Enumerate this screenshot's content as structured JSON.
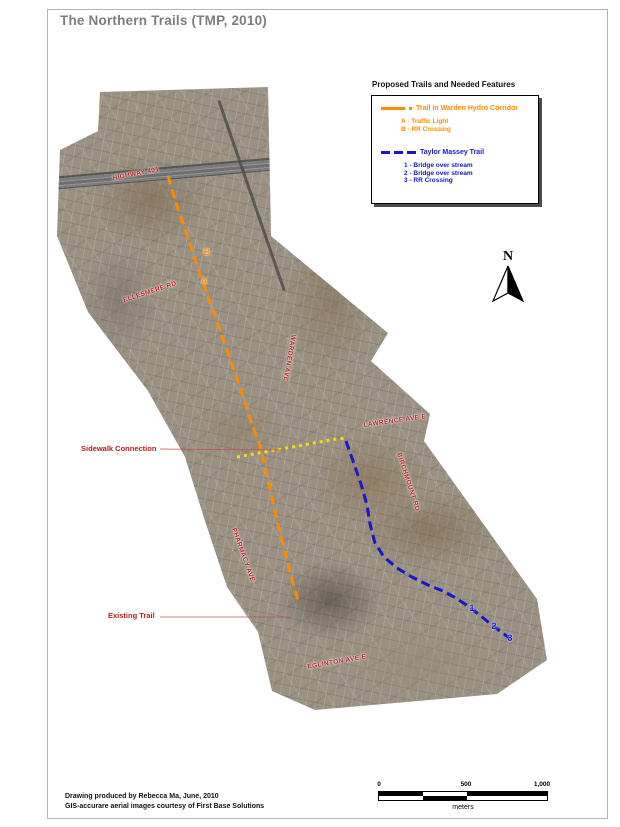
{
  "page": {
    "title": "The Northern Trails (TMP, 2010)",
    "credits": [
      "Drawing produced by Rebecca Ma, June, 2010",
      "GIS-accurare aerial images courtesy of First Base Solutions"
    ]
  },
  "legend": {
    "title": "Proposed Trails and Needed Features",
    "sections": [
      {
        "label": "Trail in Warden Hydro Corridor",
        "color": "#ff8a00",
        "line_style": "solid-with-dot",
        "items": [
          "A - Traffic Light",
          "B - RR Crossing"
        ]
      },
      {
        "label": "Taylor Massey Trail",
        "color": "#1717ce",
        "line_style": "dashed",
        "items": [
          "1 - Bridge over stream",
          "2 - Bridge over stream",
          "3 - RR Crossing"
        ]
      }
    ]
  },
  "compass": {
    "label": "N"
  },
  "scalebar": {
    "labels": [
      "0",
      "500",
      "1,000"
    ],
    "unit": "meters"
  },
  "colors": {
    "orange_trail": "#ff8a00",
    "blue_trail": "#1717ce",
    "yellow_connection": "#f2e205",
    "street_label": "#b51c1c",
    "leader_line": "#c05050",
    "title_gray": "#7d7d7d"
  },
  "map": {
    "street_labels": [
      {
        "text": "HIGHWAY 401",
        "x": 136,
        "y": 174,
        "rot": -11
      },
      {
        "text": "ELLESMERE RD",
        "x": 150,
        "y": 292,
        "rot": -18
      },
      {
        "text": "WARDEN AVE",
        "x": 289,
        "y": 358,
        "rot": 100
      },
      {
        "text": "LAWRENCE AVE E",
        "x": 395,
        "y": 421,
        "rot": -8
      },
      {
        "text": "BIRCHMOUNT RD",
        "x": 408,
        "y": 482,
        "rot": 72
      },
      {
        "text": "PHARMACY AVE",
        "x": 243,
        "y": 555,
        "rot": 70
      },
      {
        "text": "EGLINTON AVE E",
        "x": 337,
        "y": 662,
        "rot": -10
      }
    ],
    "annotations": [
      {
        "text": "Sidewalk Connection",
        "x": 81,
        "y": 444
      },
      {
        "text": "Existing Trail",
        "x": 108,
        "y": 611
      }
    ],
    "leader_lines": [
      {
        "x1": 160,
        "y1": 449,
        "x2": 284,
        "y2": 450
      },
      {
        "x1": 160,
        "y1": 617,
        "x2": 291,
        "y2": 617
      }
    ],
    "markers": [
      {
        "label": "B",
        "x": 207,
        "y": 252,
        "color": "#ff8a00"
      },
      {
        "label": "A",
        "x": 204,
        "y": 281,
        "color": "#ff8a00"
      },
      {
        "label": "1",
        "x": 472,
        "y": 608,
        "color": "#1717ce"
      },
      {
        "label": "2",
        "x": 494,
        "y": 626,
        "color": "#1717ce"
      },
      {
        "label": "3",
        "x": 510,
        "y": 638,
        "color": "#1717ce"
      }
    ],
    "trails": [
      {
        "name": "trail-warden-hydro-corridor",
        "color": "#ff8a00",
        "width": 3,
        "dash": "9 5",
        "points": [
          [
            168,
            176
          ],
          [
            176,
            203
          ],
          [
            186,
            232
          ],
          [
            196,
            262
          ],
          [
            206,
            291
          ],
          [
            215,
            316
          ],
          [
            224,
            342
          ],
          [
            234,
            370
          ],
          [
            243,
            397
          ],
          [
            252,
            424
          ],
          [
            261,
            449
          ],
          [
            266,
            471
          ],
          [
            271,
            493
          ],
          [
            277,
            521
          ],
          [
            284,
            548
          ],
          [
            290,
            572
          ],
          [
            296,
            594
          ],
          [
            299,
            603
          ]
        ]
      },
      {
        "name": "sidewalk-connection-link",
        "color": "#f2e205",
        "width": 3,
        "dash": "3 4",
        "points": [
          [
            237,
            457
          ],
          [
            270,
            451
          ],
          [
            303,
            445
          ],
          [
            330,
            440
          ],
          [
            345,
            438
          ]
        ]
      },
      {
        "name": "taylor-massey-trail",
        "color": "#1717ce",
        "width": 3,
        "dash": "9 5",
        "points": [
          [
            346,
            441
          ],
          [
            353,
            461
          ],
          [
            361,
            484
          ],
          [
            367,
            505
          ],
          [
            370,
            524
          ],
          [
            375,
            543
          ],
          [
            384,
            557
          ],
          [
            397,
            568
          ],
          [
            412,
            577
          ],
          [
            428,
            585
          ],
          [
            443,
            591
          ],
          [
            456,
            598
          ],
          [
            468,
            606
          ],
          [
            481,
            616
          ],
          [
            493,
            626
          ],
          [
            504,
            634
          ],
          [
            513,
            641
          ]
        ]
      }
    ]
  }
}
